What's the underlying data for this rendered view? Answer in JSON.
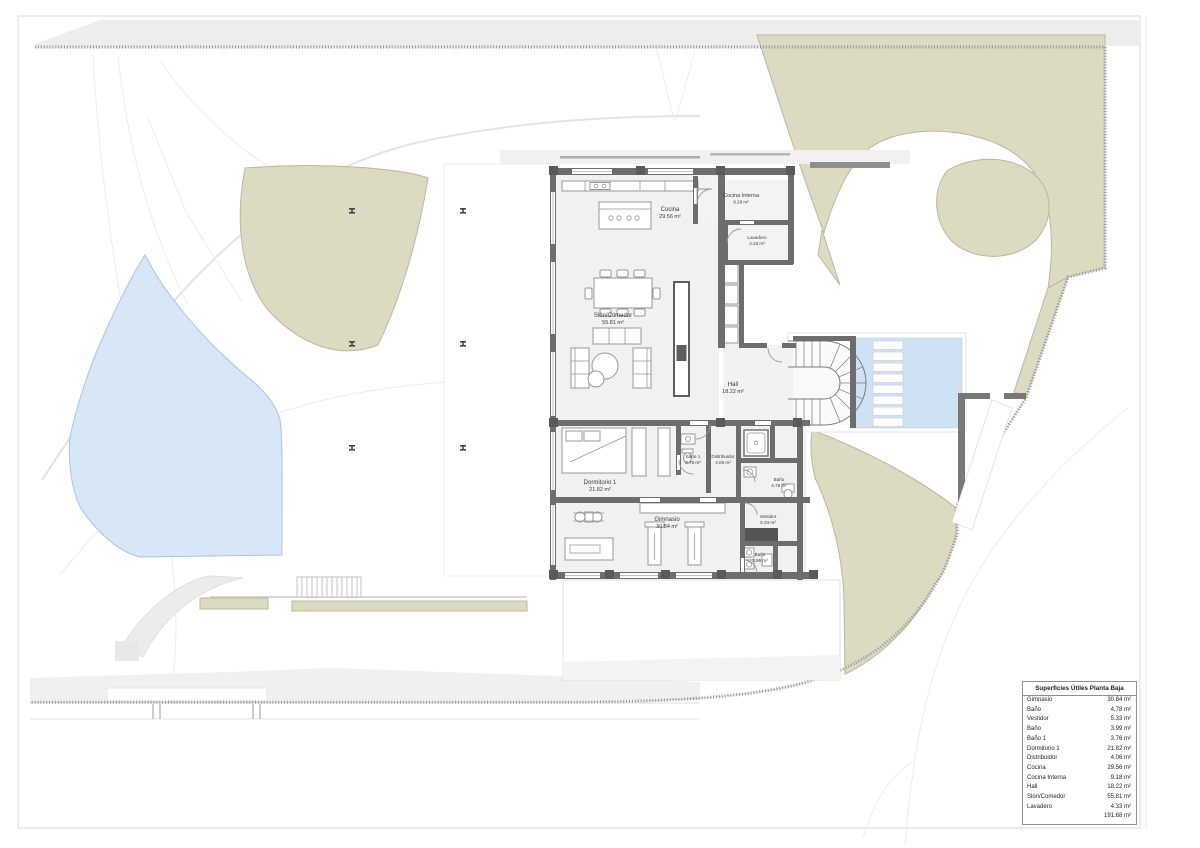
{
  "colors": {
    "paper": "#ffffff",
    "band_gray": "#ededed",
    "road_gray": "#e3e3e3",
    "green": "#dcdbc1",
    "green_edge": "#b9b8a0",
    "pond_blue": "#d7e7f7",
    "pond_edge": "#a8c4e0",
    "pool_blue": "#cfe2f4",
    "wall_dark": "#6d6d6d",
    "fence_gray": "#9a9a9a",
    "text_dark": "#3a3a3a"
  },
  "area_table": {
    "title": "Superficies Útiles Planta Baja",
    "rows": [
      {
        "name": "Gimnasio",
        "area": "30.84 m²"
      },
      {
        "name": "Baño",
        "area": "4.78 m²"
      },
      {
        "name": "Vestidor",
        "area": "5.33 m²"
      },
      {
        "name": "Baño",
        "area": "3.99 m²"
      },
      {
        "name": "Baño 1",
        "area": "3.76 m²"
      },
      {
        "name": "Dormitorio 1",
        "area": "21.82 m²"
      },
      {
        "name": "Distribuidor",
        "area": "4.06 m²"
      },
      {
        "name": "Cocina",
        "area": "29.56 m²"
      },
      {
        "name": "Cocina Interna",
        "area": "9.18 m²"
      },
      {
        "name": "Hall",
        "area": "18.22 m²"
      },
      {
        "name": "Slón/Comedor",
        "area": "55.81 m²"
      },
      {
        "name": "Lavadero",
        "area": "4.33 m²"
      }
    ],
    "total": "191.68 m²"
  },
  "plan_labels": {
    "cocina": {
      "name": "Cocina",
      "area": "29.56 m²"
    },
    "cocina_interna": {
      "name": "Cocina Interna",
      "area": "9.18 m²"
    },
    "lavadero": {
      "name": "Lavadero",
      "area": "4.33 m²"
    },
    "salon": {
      "name": "Slón/Comedor",
      "area": "55.81 m²"
    },
    "hall": {
      "name": "Hall",
      "area": "18.22 m²"
    },
    "dormitorio1": {
      "name": "Dormitorio 1",
      "area": "21.82 m²"
    },
    "bano1": {
      "name": "Baño 1",
      "area": "3.76 m²"
    },
    "distribuidor": {
      "name": "Distribuidor",
      "area": "4.06 m²"
    },
    "bano_suite": {
      "name": "Baño",
      "area": "4.78 m²"
    },
    "gimnasio": {
      "name": "Gimnasio",
      "area": "30.84 m²"
    },
    "vestidor": {
      "name": "Vestidor",
      "area": "5.33 m²"
    },
    "bano_gym": {
      "name": "Baño",
      "area": "3.99 m²"
    }
  }
}
